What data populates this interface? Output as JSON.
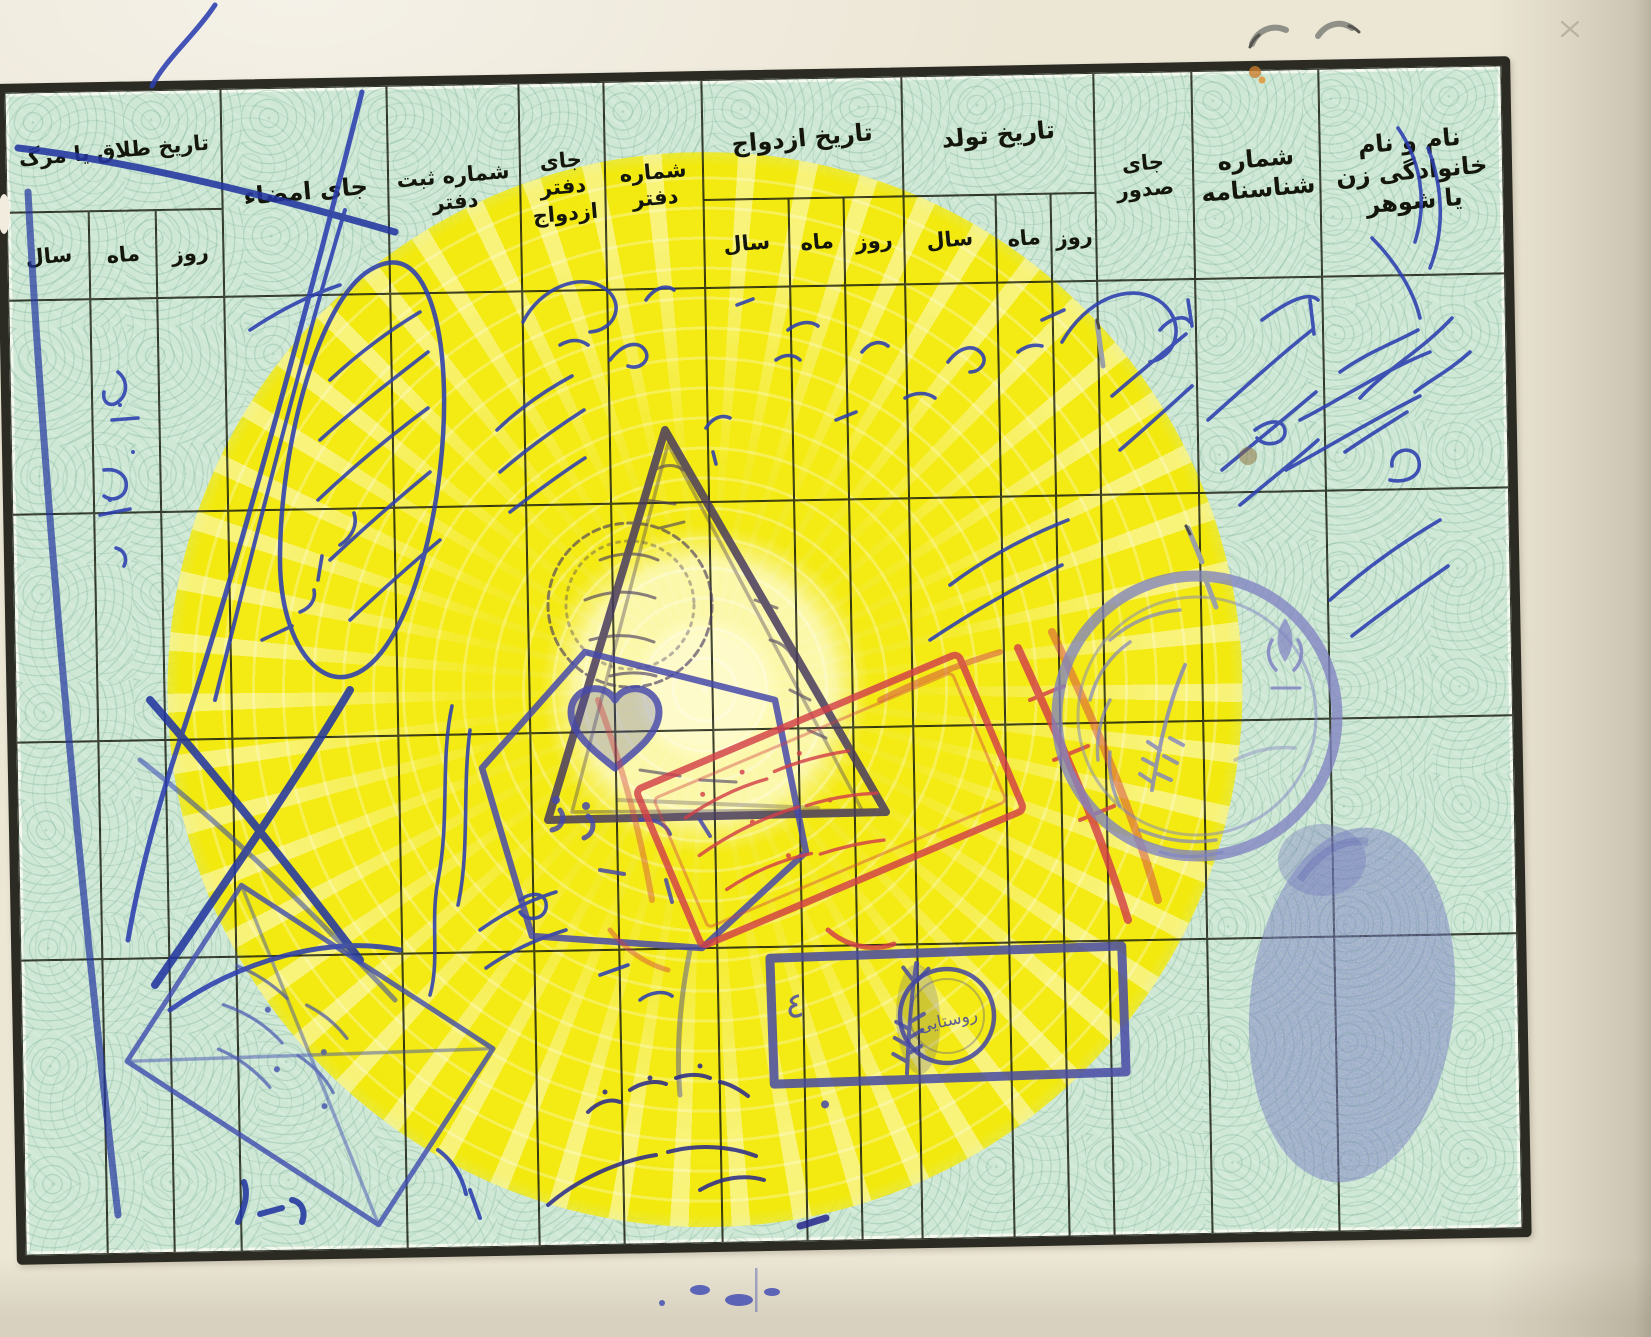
{
  "document": {
    "kind_label": "",
    "table": {
      "columns": {
        "name": "نام و نام خانوادگی زن یا شوهر",
        "id_number": "شماره شناسنامه",
        "issue_place": "جای صدور",
        "birth_date": "تاریخ تولد",
        "marriage_date": "تاریخ ازدواج",
        "office_number": "شماره دفتر",
        "marriage_office_place": "جای دفتر ازدواج",
        "office_register_number": "شماره ثبت دفتر",
        "signature_place": "جای امضاء",
        "divorce_death_date": "تاریخ طلاق یا مرگ"
      },
      "sub_headers": {
        "day": "روز",
        "month": "ماه",
        "year": "سال"
      },
      "data_rows": 4
    },
    "stamps": [
      {
        "name": "triangle-stamp",
        "text": "",
        "legible": false,
        "color": "#473a5e"
      },
      {
        "name": "round-stamp-in-triangle",
        "text": "",
        "legible": false,
        "color": "#473a5e"
      },
      {
        "name": "hexagon-stamp",
        "text": "",
        "legible": false,
        "color": "#4648aa"
      },
      {
        "name": "red-rectangle-stamp",
        "text": "",
        "legible": false,
        "color": "#d23f48"
      },
      {
        "name": "purple-round-stamp",
        "text": "",
        "legible": false,
        "color": "#8083c2"
      },
      {
        "name": "wheat-box-stamp",
        "text": "٤",
        "legible": true,
        "color": "#4649a4"
      },
      {
        "name": "rural-round-stamp",
        "text": "روستایی",
        "legible": true,
        "color": "#4245a0"
      },
      {
        "name": "envelope-stamp",
        "text": "",
        "legible": false,
        "color": "#3e4cae"
      },
      {
        "name": "bottom-arc-stamp",
        "text": "",
        "legible": false,
        "color": "#26268c"
      }
    ],
    "marks": {
      "fingerprint": "blue ink fingerprint",
      "handwriting": "blue cursive Persian entries (illegible)",
      "staples": 2
    },
    "colors": {
      "paper": "#ece6d5",
      "sheet": "#cfe8d6",
      "sun": "#f4ea14",
      "grid_line": "#181b0e",
      "ink_blue": "#2c3eb0",
      "stamp_red": "#d23f48",
      "stamp_purple": "#8083c2",
      "stamp_indigo": "#4648aa",
      "fingerprint": "#4a52a6"
    }
  }
}
